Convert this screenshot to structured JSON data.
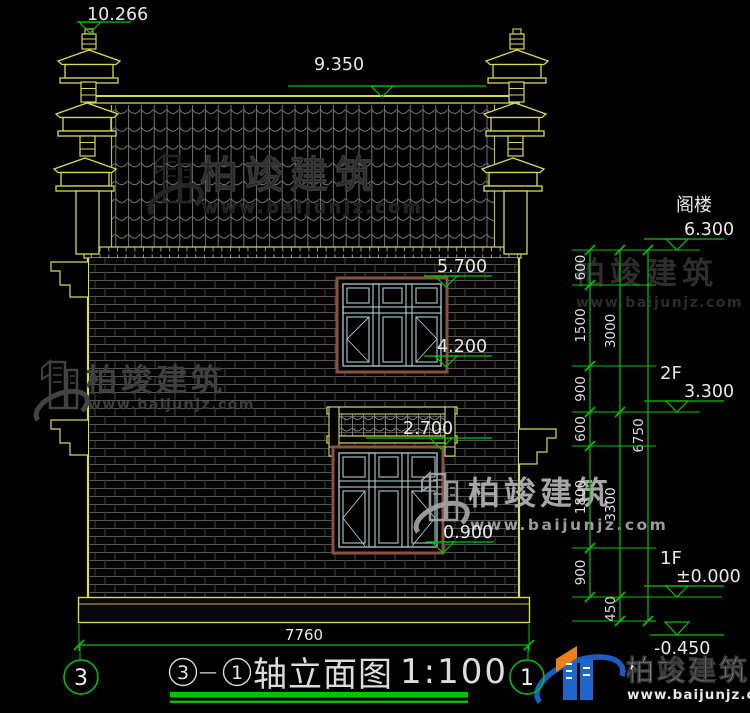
{
  "watermark": {
    "brand": "柏竣建筑",
    "url": "www.baijunjz.com"
  },
  "logo": {
    "brand": "柏竣建筑",
    "url": "www.baijunjz.com"
  },
  "levels": {
    "marks": [
      {
        "value": "10.266"
      },
      {
        "value": "9.350"
      },
      {
        "value": "5.700"
      },
      {
        "value": "4.200"
      },
      {
        "value": "2.700"
      },
      {
        "value": "0.900"
      },
      {
        "label": "阁楼",
        "value": "6.300"
      },
      {
        "label": "2F",
        "value": "3.300"
      },
      {
        "label": "1F",
        "value": "±0.000"
      },
      {
        "value": "-0.450"
      }
    ]
  },
  "dimensions": {
    "chain_inner": [
      "600",
      "1500",
      "900",
      "600",
      "1800",
      "900"
    ],
    "chain_middle": [
      "3000",
      "3300",
      "450"
    ],
    "chain_outer": [
      "6750"
    ],
    "bottom_width": "7760"
  },
  "title_block": {
    "axis_left": "3",
    "axis_right": "1",
    "separator": "—",
    "drawing_name": "轴立面图",
    "scale": "1:100"
  },
  "colors": {
    "cad_yellow": "#d8d858",
    "dim_green": "#00c400",
    "frame_teal": "#aacccc",
    "lintel_brown": "#8a5040",
    "logo_blue": "#1f66cc",
    "logo_orange": "#ef7f17"
  }
}
